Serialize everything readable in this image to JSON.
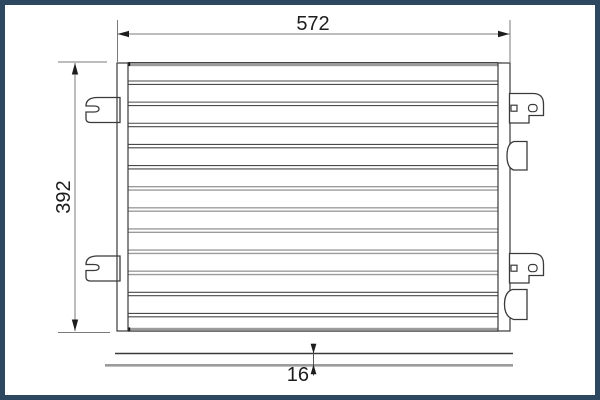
{
  "drawing": {
    "kind": "condenser-technical-drawing",
    "dimensions": {
      "width": {
        "label": "572"
      },
      "height": {
        "label": "392"
      },
      "depth": {
        "label": "16"
      }
    },
    "core": {
      "tube_rows": 12
    },
    "colors": {
      "frame_border": "#2d4760",
      "line_dark": "#3a3a3a",
      "tube_dark": "#4a4a4a",
      "tube_gray": "#9b9b9b",
      "header_gray": "#9b9b9b",
      "dim_line": "#7a7a7a",
      "arrow": "#1d1d1d",
      "text": "#1d1d1d",
      "background": "#ffffff"
    }
  }
}
